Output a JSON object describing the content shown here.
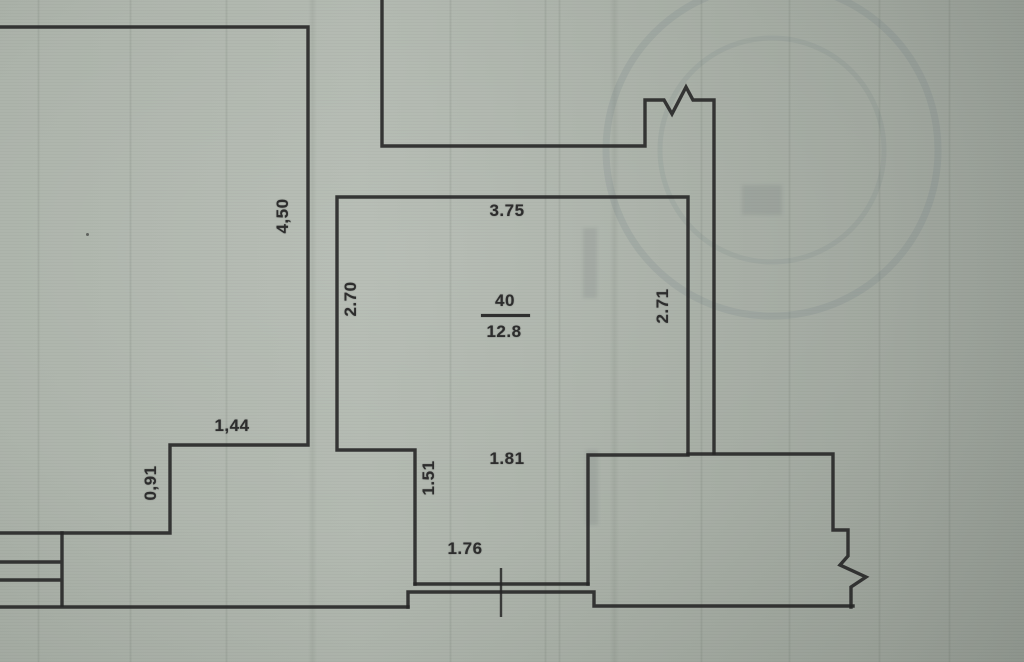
{
  "document_kind": "scanned apartment floor plan fragment",
  "colors": {
    "paper": "#a9b0a7",
    "ink": "#2a2a2a",
    "label_ink": "#2d2d2d"
  },
  "plan": {
    "room": {
      "number": "40",
      "area": "12.8"
    },
    "dimensions": {
      "d450": "4,50",
      "d375": "3.75",
      "d270": "2.70",
      "d271": "2.71",
      "d144": "1,44",
      "d091": "0,91",
      "d151": "1.51",
      "d181": "1.81",
      "d176": "1.76"
    }
  }
}
